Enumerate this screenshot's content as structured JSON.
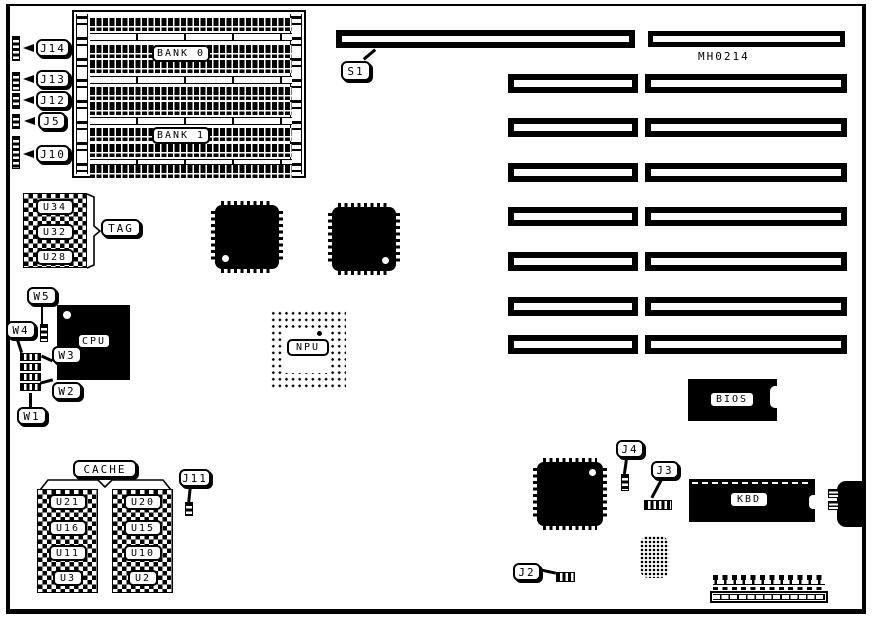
{
  "board": {
    "part_number": "MH0214",
    "memory": {
      "bank0": "BANK 0",
      "bank1": "BANK 1"
    },
    "left_jumpers": [
      {
        "label": "J14"
      },
      {
        "label": "J13"
      },
      {
        "label": "J12"
      },
      {
        "label": "J5"
      },
      {
        "label": "J10"
      }
    ],
    "tag": {
      "callout": "TAG",
      "chips": [
        {
          "label": "U34"
        },
        {
          "label": "U32"
        },
        {
          "label": "U28"
        }
      ]
    },
    "cpu": {
      "label": "CPU"
    },
    "npu": {
      "label": "NPU"
    },
    "cpu_jumpers": [
      {
        "label": "W5"
      },
      {
        "label": "W4"
      },
      {
        "label": "W3"
      },
      {
        "label": "W2"
      },
      {
        "label": "W1"
      }
    ],
    "slots": {
      "s1": "S1"
    },
    "bios": {
      "label": "BIOS"
    },
    "kbd": {
      "label": "KBD"
    },
    "jumpers": {
      "j4": "J4",
      "j3": "J3",
      "j2": "J2",
      "j11": "J11"
    },
    "cache": {
      "callout": "CACHE",
      "left_chips": [
        {
          "label": "U21"
        },
        {
          "label": "U16"
        },
        {
          "label": "U11"
        },
        {
          "label": "U3"
        }
      ],
      "right_chips": [
        {
          "label": "U20"
        },
        {
          "label": "U15"
        },
        {
          "label": "U10"
        },
        {
          "label": "U2"
        }
      ]
    },
    "colors": {
      "ink": "#000000",
      "paper": "#ffffff"
    }
  }
}
